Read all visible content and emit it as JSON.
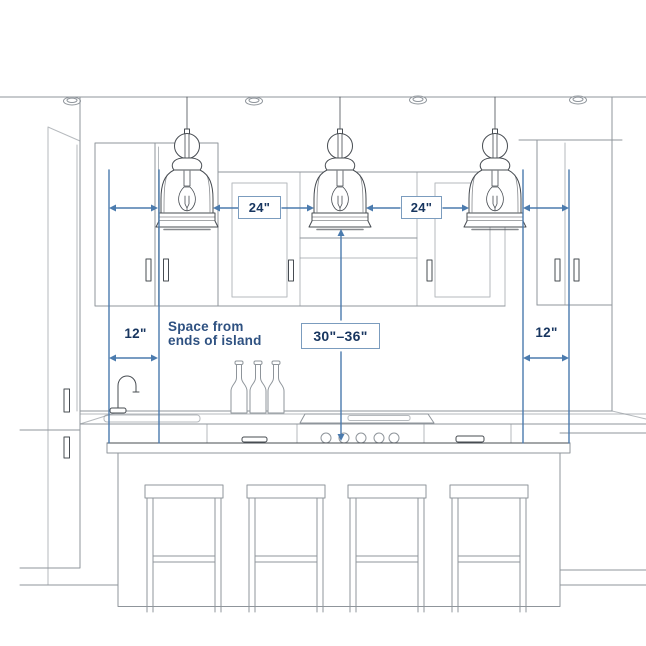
{
  "measurements": {
    "pendant_gap_left": "24\"",
    "pendant_gap_right": "24\"",
    "height_above_island": "30\"–36\"",
    "end_offset_left": "12\"",
    "end_offset_right": "12\"",
    "note_line1": "Space from",
    "note_line2": "ends of island"
  },
  "colors": {
    "dimension_line": "#4b7bae",
    "box_border": "#7b9cbe",
    "label_text": "#17355f",
    "note_text": "#2e5181",
    "sketch_light": "#8f959b",
    "sketch_dark": "#474c52",
    "background": "#ffffff"
  },
  "scene_elements": [
    "ceiling recessed lights",
    "three glass bell pendant lights",
    "upper wall cabinets",
    "range hood niche",
    "kitchen island with sink, cooktop and drawers",
    "gooseneck faucet",
    "three bottles",
    "four bar stools"
  ]
}
